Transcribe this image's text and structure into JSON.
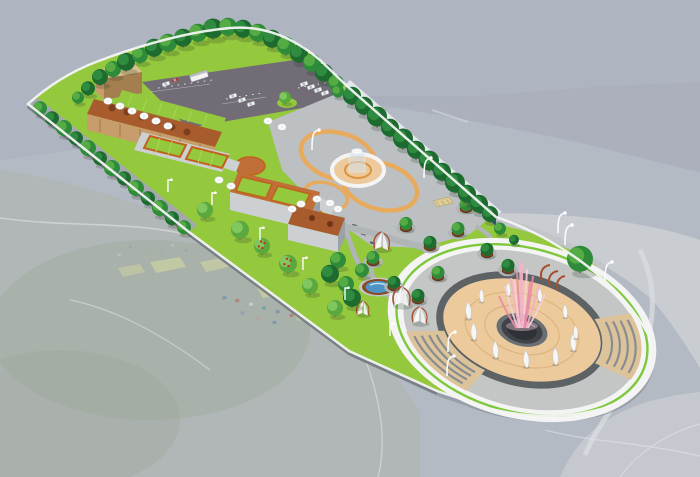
{
  "image": {
    "type": "architectural-3d-rendering",
    "subject": "aerial bird's-eye rendering of an elongated riverside park and rest-area complex",
    "background": "faded aerial photograph of a valley with mountains, river, fields and a village",
    "features": [
      "parking lot with cars and bus",
      "terraced buildings with roof gardens and umbrellas",
      "tree-lined promenade",
      "blue perimeter screen fence",
      "central plaza with quatrefoil path and glass fountain",
      "garden with winding paths, tree planters, shade sails, pergolas and pond",
      "large circular amphitheater plaza with pink fountain jets and white sail sculptures"
    ]
  },
  "colors": {
    "bgBase": "#b4bac3",
    "bgMountain": "#adb4bf",
    "bgRidge": "#a6adb9",
    "bgRiver": "#ccd0d5",
    "bgLand": "#aeb5ad",
    "bgField": "#d4da9e",
    "lawn": "#94c83d",
    "lawnLight": "#b3da5c",
    "lawnDark": "#6aa42e",
    "road": "#a2a8ad",
    "parking": "#716c76",
    "plaza": "#bcc0c2",
    "gardenPath": "#b0b5b8",
    "pathOrange": "#e8ab5e",
    "pathOrangeDeep": "#dd9440",
    "tanWall": "#c79e6b",
    "tanLight": "#dcbf8e",
    "tanDark": "#a57e4f",
    "roofBrown": "#a85c2e",
    "roofBrownLight": "#bf6f37",
    "terraceOrange": "#c2611d",
    "concrete": "#ccd0d2",
    "concreteShadow": "#9ba2a7",
    "rimWhite": "#f3f4f3",
    "circleGray": "#c3c6c4",
    "circleTan": "#ecca9c",
    "stepsBuff": "#dcc39a",
    "stepLine": "#878d91",
    "seatRing": "#5d6265",
    "greenRing": "#7ec83c",
    "basin": "#3f4347",
    "fence": "#2e4f86",
    "fenceRail": "#c3cfdf",
    "pond": "#4f93c4",
    "planter": "#8a4a26",
    "rust": "#a5502e",
    "trunk": "#6b4a2a",
    "fruit": "#cc2a1e",
    "fountainPink": "#f2b3c6",
    "fountainPinkDeep": "#e98ca9",
    "fountainPinkPale": "#f6cdd9",
    "carBody": "#f2f3f2",
    "carRed": "#a83b33",
    "lamp": "#fafbfc",
    "wallShadow": "#70777e"
  },
  "treeShades": [
    [
      "#1d6b2f",
      "#2f8b3f"
    ],
    [
      "#2e8b3a",
      "#55ab44"
    ],
    [
      "#5aa83e",
      "#7fc75e"
    ]
  ],
  "scene": {
    "trees": [
      [
        100,
        79,
        8,
        0
      ],
      [
        113,
        71,
        8,
        1
      ],
      [
        126,
        64,
        9,
        0
      ],
      [
        140,
        57,
        8,
        1
      ],
      [
        154,
        50,
        9,
        0
      ],
      [
        168,
        45,
        9,
        1
      ],
      [
        183,
        40,
        9,
        0
      ],
      [
        198,
        35,
        9,
        1
      ],
      [
        213,
        31,
        10,
        0
      ],
      [
        228,
        29,
        9,
        1
      ],
      [
        243,
        31,
        9,
        0
      ],
      [
        258,
        35,
        9,
        1
      ],
      [
        272,
        41,
        9,
        0
      ],
      [
        286,
        48,
        9,
        1
      ],
      [
        299,
        56,
        9,
        0
      ],
      [
        312,
        65,
        9,
        1
      ],
      [
        324,
        75,
        9,
        0
      ],
      [
        336,
        85,
        8,
        1
      ],
      [
        352,
        98,
        9,
        0
      ],
      [
        364,
        108,
        9,
        0
      ],
      [
        377,
        119,
        10,
        0
      ],
      [
        390,
        130,
        9,
        0
      ],
      [
        403,
        141,
        10,
        0
      ],
      [
        416,
        152,
        9,
        0
      ],
      [
        429,
        163,
        10,
        0
      ],
      [
        442,
        174,
        9,
        0
      ],
      [
        455,
        185,
        10,
        0
      ],
      [
        467,
        196,
        9,
        0
      ],
      [
        479,
        206,
        9,
        0
      ],
      [
        490,
        216,
        8,
        0
      ],
      [
        40,
        110,
        7,
        1
      ],
      [
        52,
        120,
        7,
        0
      ],
      [
        64,
        130,
        8,
        1
      ],
      [
        76,
        140,
        7,
        0
      ],
      [
        88,
        150,
        8,
        1
      ],
      [
        100,
        160,
        7,
        0
      ],
      [
        112,
        170,
        8,
        1
      ],
      [
        124,
        180,
        7,
        0
      ],
      [
        136,
        190,
        8,
        1
      ],
      [
        148,
        200,
        7,
        0
      ],
      [
        160,
        210,
        8,
        1
      ],
      [
        172,
        220,
        7,
        0
      ],
      [
        184,
        229,
        7,
        1
      ],
      [
        205,
        212,
        8,
        2,
        0
      ],
      [
        240,
        232,
        9,
        2,
        0
      ],
      [
        262,
        248,
        8,
        2,
        1
      ],
      [
        288,
        266,
        9,
        2,
        1
      ],
      [
        310,
        288,
        8,
        2,
        0
      ],
      [
        335,
        310,
        8,
        2,
        0
      ],
      [
        285,
        99,
        6,
        2
      ],
      [
        338,
        93,
        6,
        1
      ],
      [
        88,
        90,
        7,
        0
      ],
      [
        78,
        99,
        6,
        1
      ],
      [
        338,
        262,
        8,
        1
      ],
      [
        330,
        276,
        9,
        0
      ],
      [
        346,
        286,
        8,
        1
      ],
      [
        352,
        300,
        9,
        0
      ],
      [
        362,
        272,
        7,
        1
      ],
      [
        580,
        262,
        13,
        1
      ],
      [
        500,
        230,
        6,
        1
      ],
      [
        514,
        241,
        5,
        0
      ]
    ],
    "planters": [
      [
        406,
        228,
        1
      ],
      [
        430,
        247,
        0
      ],
      [
        458,
        233,
        1
      ],
      [
        487,
        254,
        0
      ],
      [
        466,
        209,
        1
      ],
      [
        508,
        270,
        0
      ],
      [
        373,
        262,
        1
      ],
      [
        394,
        287,
        0
      ],
      [
        438,
        277,
        1
      ],
      [
        418,
        300,
        0
      ]
    ],
    "tents": [
      [
        382,
        247,
        1
      ],
      [
        402,
        303,
        1.1
      ],
      [
        420,
        321,
        0.95
      ],
      [
        363,
        313,
        0.8
      ]
    ],
    "cars": [
      [
        166,
        84,
        0
      ],
      [
        175,
        80,
        1
      ],
      [
        233,
        96,
        0
      ],
      [
        242,
        100,
        0
      ],
      [
        251,
        104,
        0
      ],
      [
        304,
        84,
        0
      ],
      [
        311,
        87,
        0
      ],
      [
        318,
        90,
        0
      ],
      [
        325,
        93,
        0
      ]
    ],
    "bus": [
      199,
      76
    ],
    "umbrellas": [
      [
        108,
        101
      ],
      [
        120,
        106
      ],
      [
        132,
        111
      ],
      [
        144,
        116
      ],
      [
        156,
        121
      ],
      [
        168,
        126
      ],
      [
        268,
        121
      ],
      [
        282,
        127
      ],
      [
        219,
        180
      ],
      [
        231,
        186
      ],
      [
        292,
        209
      ],
      [
        301,
        204
      ],
      [
        317,
        199
      ],
      [
        330,
        203
      ],
      [
        338,
        209
      ]
    ],
    "lamps": [
      [
        168,
        192,
        "s"
      ],
      [
        212,
        205,
        "s"
      ],
      [
        260,
        240,
        "s"
      ],
      [
        303,
        270,
        "s"
      ],
      [
        345,
        300,
        "s"
      ],
      [
        390,
        336,
        "s"
      ],
      [
        312,
        150,
        "c"
      ],
      [
        424,
        178,
        "c"
      ],
      [
        448,
        352,
        "c"
      ],
      [
        447,
        376,
        "c"
      ],
      [
        565,
        245,
        "c"
      ],
      [
        605,
        282,
        "c"
      ],
      [
        558,
        233,
        "c"
      ]
    ],
    "jets": [
      [
        0,
        62
      ],
      [
        -5,
        55
      ],
      [
        5,
        57
      ],
      [
        -11,
        48
      ],
      [
        11,
        50
      ],
      [
        -17,
        40
      ],
      [
        17,
        42
      ],
      [
        -23,
        30
      ],
      [
        23,
        32
      ],
      [
        -2,
        66
      ],
      [
        8,
        44
      ],
      [
        -8,
        46
      ]
    ],
    "sailAngles": [
      8,
      42,
      76,
      110,
      144,
      178,
      212,
      246,
      280,
      314,
      348
    ],
    "sailRadius": [
      55,
      34
    ],
    "circleCenter": [
      522,
      330
    ],
    "circleRotation": 15
  }
}
